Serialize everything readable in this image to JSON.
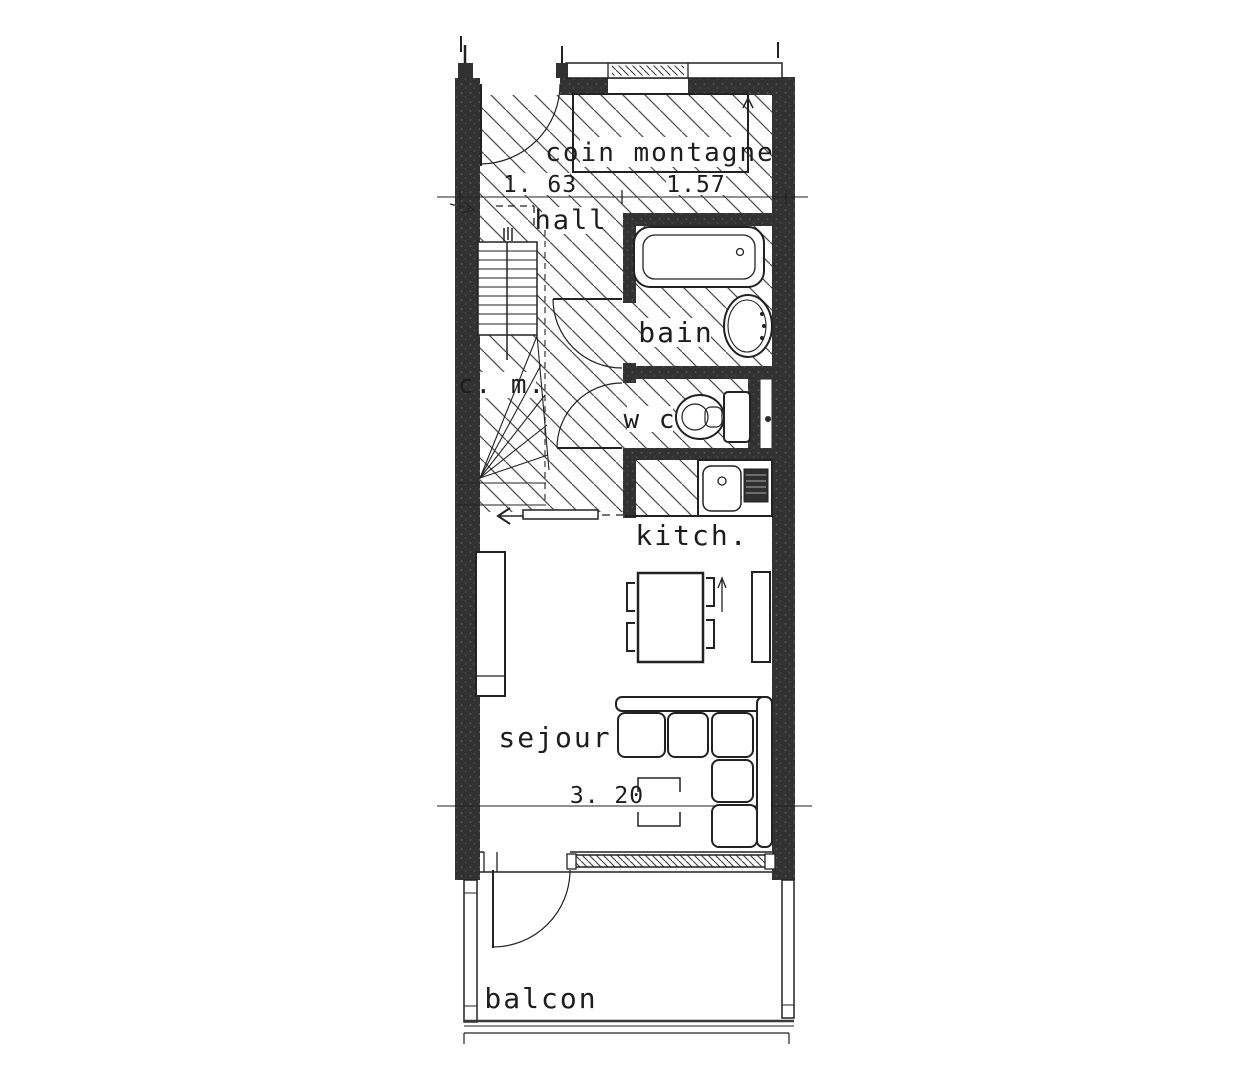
{
  "colors": {
    "ink": "#1d1d1d",
    "wall_fill": "#333333",
    "paper": "#ffffff"
  },
  "labels": {
    "coin_montagne": "coin montagne",
    "hall": "hall",
    "bain": "bain",
    "cm": "c. m.",
    "wc": "w c",
    "kitchen": "kitch.",
    "sejour": "sejour",
    "balcony": "balcon"
  },
  "dimensions": {
    "entry": "1. 63",
    "coin": "1.57",
    "sejour": "3. 20"
  }
}
